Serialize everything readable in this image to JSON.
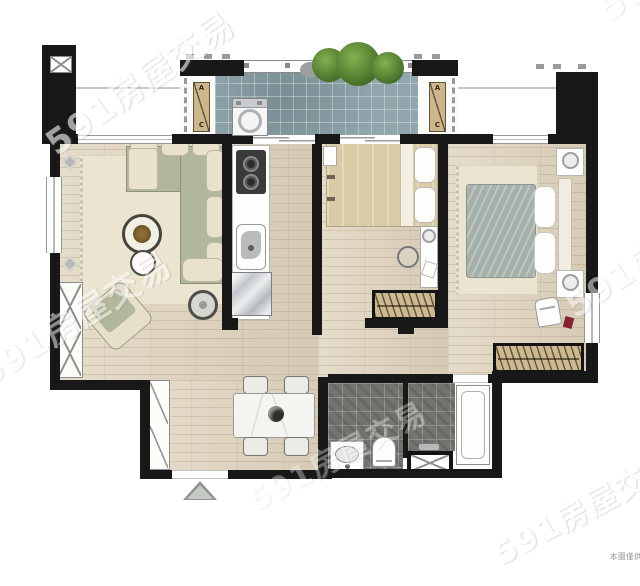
{
  "watermarks": [
    "591房屋交易",
    "591房屋交易",
    "591房屋交易",
    "591房屋交易",
    "591房屋交易",
    "591房屋交易"
  ],
  "ac_unit": {
    "top_letter": "A",
    "bottom_letter": "C"
  },
  "disclaimer_text": "本圖僅供",
  "colors": {
    "wall": "#181818",
    "wood_floor": "#ded2bb",
    "balcony_tile": "#90a6ac",
    "bathroom_tile": "#73736f",
    "sofa_green": "#b1b79a",
    "cushion_cream": "#e9e1cb",
    "wardrobe_tan": "#cdb991",
    "master_duvet": "#a5b0aa",
    "bedroom_duvet": "#d8cba6",
    "plant_green": "#5e8b3d",
    "rug_cream": "#ebe4d0",
    "watermark": "#ffffff"
  }
}
